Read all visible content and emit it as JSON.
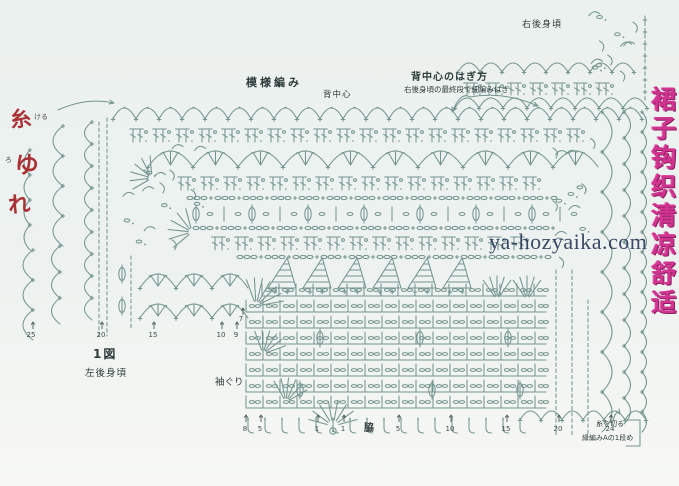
{
  "labels": {
    "pattern_stitch": "模様編み",
    "back_center": "背中心",
    "back_center_join_title": "背中心のはぎ方",
    "back_center_join_sub": "右後身頃の最終段で細編みはぎ",
    "right_back_panel": "右後身頃",
    "figure1": "1図",
    "left_back_panel": "左後身頃",
    "armhole": "袖ぐり",
    "side_seam": "脇",
    "cut_yarn": "糸を切る",
    "edging_row1": "縁編みAの1段め"
  },
  "watermark": "ya-hozyaika.com",
  "vertical_banner": "裙子钩织清凉舒适",
  "red_annotations": {
    "char1": "糸",
    "char1_note": "ける",
    "char2": "ゆ",
    "char2_note": "ろ",
    "char3": "れ"
  },
  "numbers": [
    {
      "x": 31,
      "y": 331,
      "v": "25"
    },
    {
      "x": 101,
      "y": 331,
      "v": "20"
    },
    {
      "x": 153,
      "y": 331,
      "v": "15"
    },
    {
      "x": 221,
      "y": 331,
      "v": "10"
    },
    {
      "x": 236,
      "y": 331,
      "v": "9"
    },
    {
      "x": 241,
      "y": 315,
      "v": "7"
    },
    {
      "x": 245,
      "y": 425,
      "v": "8"
    },
    {
      "x": 260,
      "y": 425,
      "v": "5"
    },
    {
      "x": 317,
      "y": 425,
      "v": "1"
    },
    {
      "x": 343,
      "y": 425,
      "v": "1"
    },
    {
      "x": 398,
      "y": 425,
      "v": "5"
    },
    {
      "x": 450,
      "y": 425,
      "v": "10"
    },
    {
      "x": 506,
      "y": 425,
      "v": "15"
    },
    {
      "x": 558,
      "y": 425,
      "v": "20"
    },
    {
      "x": 610,
      "y": 425,
      "v": "24"
    }
  ],
  "diagram": {
    "stroke": "#6f908b",
    "tick_color": "#4a5c5a",
    "background": "#edf2f0",
    "ticks": [
      {
        "x": 33,
        "y": 322
      },
      {
        "x": 102,
        "y": 322
      },
      {
        "x": 154,
        "y": 322
      },
      {
        "x": 222,
        "y": 322
      },
      {
        "x": 237,
        "y": 322
      },
      {
        "x": 243,
        "y": 308
      },
      {
        "x": 246,
        "y": 415
      },
      {
        "x": 261,
        "y": 415
      },
      {
        "x": 318,
        "y": 415
      },
      {
        "x": 344,
        "y": 415
      },
      {
        "x": 399,
        "y": 415
      },
      {
        "x": 451,
        "y": 415
      },
      {
        "x": 507,
        "y": 415
      },
      {
        "x": 559,
        "y": 415
      },
      {
        "x": 611,
        "y": 415
      }
    ],
    "elements": [
      {
        "t": "deeparcs",
        "x": 462,
        "y": 44,
        "w": 58,
        "h": 24,
        "n": 2
      },
      {
        "t": "arcscatter",
        "x": 578,
        "X": 645,
        "y": 14,
        "Y": 82,
        "n": 12
      },
      {
        "t": "arcrow",
        "x": 458,
        "X": 642,
        "y": 72,
        "w": 22,
        "h": 9
      },
      {
        "t": "tpair",
        "x": 462,
        "X": 630,
        "y": 95,
        "h": 12,
        "w": 22
      },
      {
        "t": "arcrow",
        "x": 455,
        "X": 650,
        "y": 108,
        "w": 24,
        "h": 10
      },
      {
        "t": "dashcol",
        "x": 645,
        "y": 16,
        "Y": 100,
        "plus": 1
      },
      {
        "t": "arcrow",
        "x": 113,
        "X": 646,
        "y": 119,
        "w": 23,
        "h": 11,
        "dots": 1
      },
      {
        "t": "tpair",
        "x": 128,
        "X": 600,
        "y": 142,
        "h": 13,
        "w": 23
      },
      {
        "t": "shellrow",
        "x": 148,
        "X": 598,
        "y": 167,
        "w": 45,
        "h": 16
      },
      {
        "t": "tpair",
        "x": 176,
        "X": 560,
        "y": 190,
        "h": 13,
        "w": 23
      },
      {
        "t": "chainrow",
        "x": 190,
        "X": 560,
        "y": 198
      },
      {
        "t": "ovalrow",
        "x": 196,
        "X": 556,
        "y": 214,
        "w": 56
      },
      {
        "t": "chainrow",
        "x": 196,
        "X": 556,
        "y": 228
      },
      {
        "t": "tpair",
        "x": 210,
        "X": 548,
        "y": 250,
        "h": 13,
        "w": 23
      },
      {
        "t": "chainrow",
        "x": 240,
        "X": 548,
        "y": 257
      },
      {
        "t": "arcscatter",
        "x": 116,
        "X": 210,
        "y": 148,
        "Y": 262,
        "n": 16
      },
      {
        "t": "fan",
        "cx": 152,
        "cy": 178,
        "r0": 4,
        "r1": 22,
        "a0": 150,
        "a1": 265,
        "n": 6
      },
      {
        "t": "fan",
        "cx": 192,
        "cy": 232,
        "r0": 4,
        "r1": 24,
        "a0": 140,
        "a1": 255,
        "n": 6
      },
      {
        "t": "dashcol",
        "x": 107,
        "y": 118,
        "Y": 336
      },
      {
        "t": "dashcol",
        "x": 99,
        "y": 122,
        "Y": 336
      },
      {
        "t": "scallopV",
        "x": 92,
        "y": 122,
        "Y": 336,
        "step": 22,
        "d": 15,
        "side": "left"
      },
      {
        "t": "scallopV",
        "x": 63,
        "y": 126,
        "Y": 246,
        "step": 30,
        "d": 20,
        "side": "left"
      },
      {
        "t": "scallopV",
        "x": 30,
        "y": 150,
        "Y": 250,
        "step": 25,
        "d": 12,
        "side": "left"
      },
      {
        "t": "scallopV",
        "x": 60,
        "y": 246,
        "Y": 340,
        "step": 26,
        "d": 17,
        "side": "left"
      },
      {
        "t": "scallopV",
        "x": 33,
        "y": 250,
        "Y": 342,
        "step": 30,
        "d": 20,
        "side": "left"
      },
      {
        "t": "curvearrow",
        "x1": 58,
        "y1": 110,
        "x2": 114,
        "y2": 103
      },
      {
        "t": "ovalv",
        "x": 122,
        "y": 274
      },
      {
        "t": "ovalv",
        "x": 122,
        "y": 306
      },
      {
        "t": "dashcol",
        "x": 131,
        "y": 256,
        "Y": 330
      },
      {
        "t": "shellrow",
        "x": 140,
        "X": 248,
        "y": 288,
        "w": 36,
        "h": 14
      },
      {
        "t": "shellrow",
        "x": 140,
        "X": 248,
        "y": 318,
        "w": 36,
        "h": 14
      },
      {
        "t": "hline",
        "x": 248,
        "X": 258,
        "y": 312
      },
      {
        "t": "trirow",
        "x": 268,
        "X": 478,
        "y": 258,
        "w": 35,
        "h": 30
      },
      {
        "t": "fan",
        "cx": 256,
        "cy": 306,
        "r0": 5,
        "r1": 28,
        "a0": 250,
        "a1": 350,
        "n": 7
      },
      {
        "t": "fan",
        "cx": 497,
        "cy": 300,
        "r0": 4,
        "r1": 24,
        "a0": 235,
        "a1": 305,
        "n": 5
      },
      {
        "t": "fan",
        "cx": 527,
        "cy": 300,
        "r0": 4,
        "r1": 24,
        "a0": 235,
        "a1": 305,
        "n": 5
      },
      {
        "t": "gridrow",
        "x": 262,
        "X": 546,
        "y": 296,
        "w": 17,
        "h": 12
      },
      {
        "t": "gridrow",
        "x": 246,
        "X": 546,
        "y": 312,
        "w": 17,
        "h": 12
      },
      {
        "t": "gridrow",
        "x": 246,
        "X": 546,
        "y": 328,
        "w": 17,
        "h": 12
      },
      {
        "t": "gridrow",
        "x": 246,
        "X": 546,
        "y": 344,
        "w": 17,
        "h": 12
      },
      {
        "t": "gridrow",
        "x": 246,
        "X": 546,
        "y": 360,
        "w": 17,
        "h": 12
      },
      {
        "t": "gridrow",
        "x": 246,
        "X": 546,
        "y": 376,
        "w": 17,
        "h": 12
      },
      {
        "t": "gridrow",
        "x": 246,
        "X": 546,
        "y": 392,
        "w": 17,
        "h": 12
      },
      {
        "t": "gridrow",
        "x": 246,
        "X": 546,
        "y": 408,
        "w": 17,
        "h": 12
      },
      {
        "t": "ovalv",
        "x": 320,
        "y": 338
      },
      {
        "t": "ovalv",
        "x": 420,
        "y": 338
      },
      {
        "t": "ovalv",
        "x": 508,
        "y": 338
      },
      {
        "t": "ovalv",
        "x": 300,
        "y": 390
      },
      {
        "t": "ovalv",
        "x": 432,
        "y": 390
      },
      {
        "t": "ovalv",
        "x": 520,
        "y": 390
      },
      {
        "t": "fan",
        "cx": 263,
        "cy": 354,
        "r0": 4,
        "r1": 24,
        "a0": 250,
        "a1": 340,
        "n": 6
      },
      {
        "t": "fan",
        "cx": 286,
        "cy": 402,
        "r0": 4,
        "r1": 24,
        "a0": 240,
        "a1": 330,
        "n": 6
      },
      {
        "t": "jrow",
        "x": 248,
        "X": 520,
        "y": 418,
        "w": 17,
        "h": 15
      },
      {
        "t": "fan",
        "cx": 333,
        "cy": 426,
        "r0": 6,
        "r1": 25,
        "a0": 195,
        "a1": 345,
        "n": 8
      },
      {
        "t": "ringdot",
        "x": 333,
        "y": 431
      },
      {
        "t": "arcrow",
        "x": 520,
        "X": 648,
        "y": 420,
        "w": 21,
        "h": 9
      },
      {
        "t": "arcscatter",
        "x": 548,
        "X": 604,
        "y": 132,
        "Y": 268,
        "n": 14
      },
      {
        "t": "dashcol",
        "x": 556,
        "y": 270,
        "Y": 436
      },
      {
        "t": "dashcol",
        "x": 572,
        "y": 270,
        "Y": 436
      },
      {
        "t": "dashcol",
        "x": 588,
        "y": 300,
        "Y": 436
      },
      {
        "t": "scallopV",
        "x": 602,
        "y": 112,
        "Y": 438,
        "step": 40,
        "d": 20,
        "side": "right"
      },
      {
        "t": "scallopV",
        "x": 624,
        "y": 112,
        "Y": 440,
        "step": 26,
        "d": 13,
        "side": "right"
      },
      {
        "t": "scallopV",
        "x": 642,
        "y": 112,
        "Y": 442,
        "step": 20,
        "d": 9,
        "side": "right"
      },
      {
        "t": "bracket",
        "x": 626,
        "y": 420,
        "X": 640,
        "Y": 446
      },
      {
        "t": "curvearrow",
        "x1": 470,
        "y1": 97,
        "x2": 452,
        "y2": 112
      },
      {
        "t": "curvearrow",
        "x1": 470,
        "y1": 97,
        "x2": 538,
        "y2": 106
      },
      {
        "t": "curvearrow",
        "x1": 612,
        "y1": 424,
        "x2": 620,
        "y2": 414
      }
    ]
  }
}
